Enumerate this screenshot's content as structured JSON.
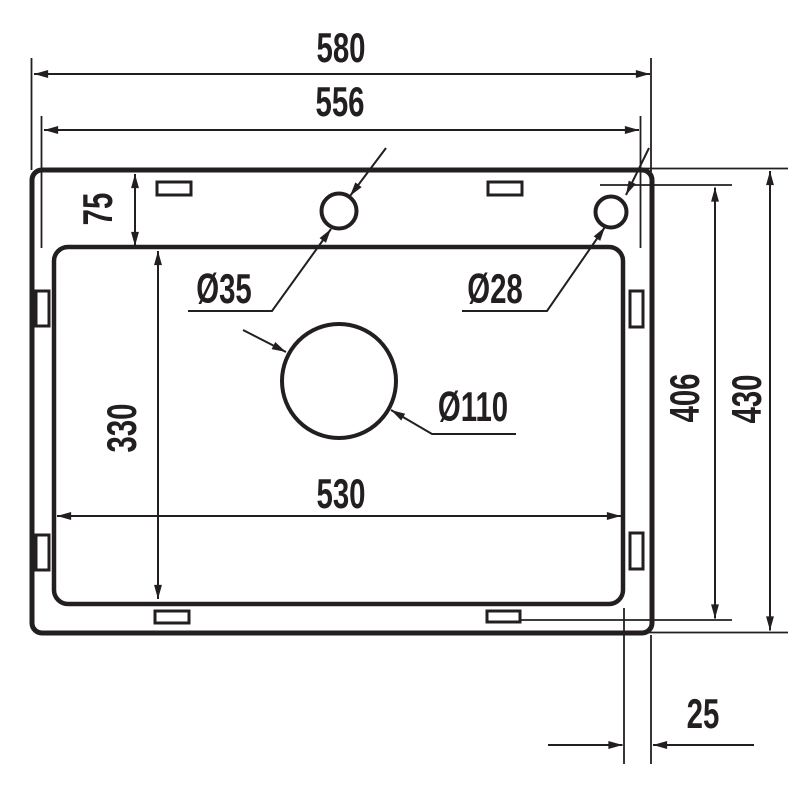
{
  "drawing": {
    "type": "technical-dimension-drawing",
    "subject": "Kitchen sink top view with cutout and hole dimensions",
    "unit": "mm",
    "colors": {
      "line": "#231f20",
      "background": "#ffffff"
    },
    "labels": {
      "overall_width": "580",
      "rim_width": "556",
      "deck_depth": "75",
      "bowl_depth": "330",
      "bowl_width": "530",
      "inner_height": "406",
      "overall_height": "430",
      "edge_offset": "25",
      "tap_hole_diameter": "Ø35",
      "accessory_hole_diameter": "Ø28",
      "drain_hole_diameter": "Ø110"
    }
  }
}
